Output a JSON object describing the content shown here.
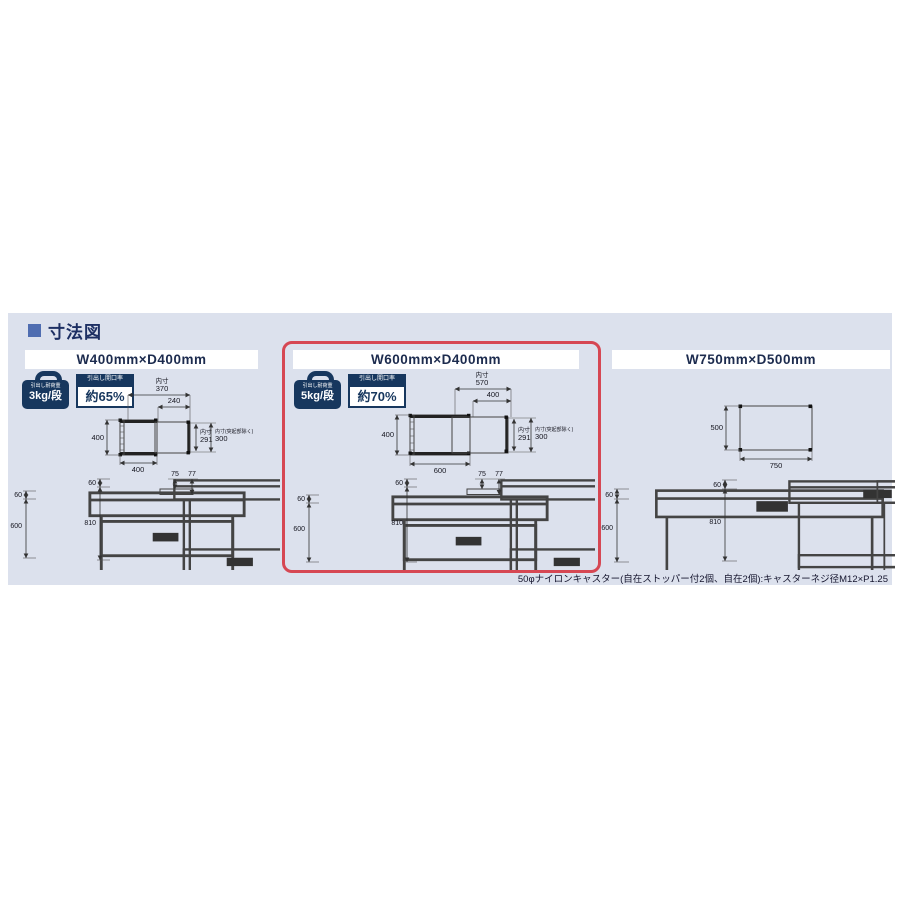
{
  "header": {
    "title": "寸法図"
  },
  "footnote": {
    "text": "50φナイロンキャスター(自在ストッパー付2個、自在2個):キャスターネジ径M12×P1.25"
  },
  "colors": {
    "accent_navy": "#17375e",
    "band_bg": "#dce1ed",
    "highlight_red": "#d64753",
    "title_navy": "#1c2b4e"
  },
  "panels": [
    {
      "title": "W400mm×D400mm",
      "badges": {
        "load_label": "引出し耐荷重",
        "load_value": "3kg/段",
        "ratio_label": "引出し開口率",
        "ratio_value": "約65%"
      },
      "topview": {
        "label_inner": "内寸",
        "inner_width": "370",
        "opening": "240",
        "depth": "400",
        "width": "400",
        "inner_depth": "291",
        "note": "内寸(突起部除く)",
        "inner_depth2": "300"
      },
      "dims": {
        "tray": "60",
        "body": "600",
        "full": "810",
        "board_a": "75",
        "board_b": "77"
      }
    },
    {
      "title": "W600mm×D400mm",
      "highlighted": true,
      "badges": {
        "load_label": "引出し耐荷重",
        "load_value": "5kg/段",
        "ratio_label": "引出し開口率",
        "ratio_value": "約70%"
      },
      "topview": {
        "label_inner": "内寸",
        "inner_width": "570",
        "opening": "400",
        "depth": "400",
        "width": "600",
        "inner_depth": "291",
        "note": "内寸(突起部除く)",
        "inner_depth2": "300"
      },
      "dims": {
        "tray": "60",
        "body": "600",
        "full": "810",
        "board_a": "75",
        "board_b": "77"
      }
    },
    {
      "title": "W750mm×D500mm",
      "topview": {
        "depth": "500",
        "width": "750"
      },
      "dims": {
        "tray": "60",
        "body": "600",
        "full": "810"
      }
    }
  ]
}
